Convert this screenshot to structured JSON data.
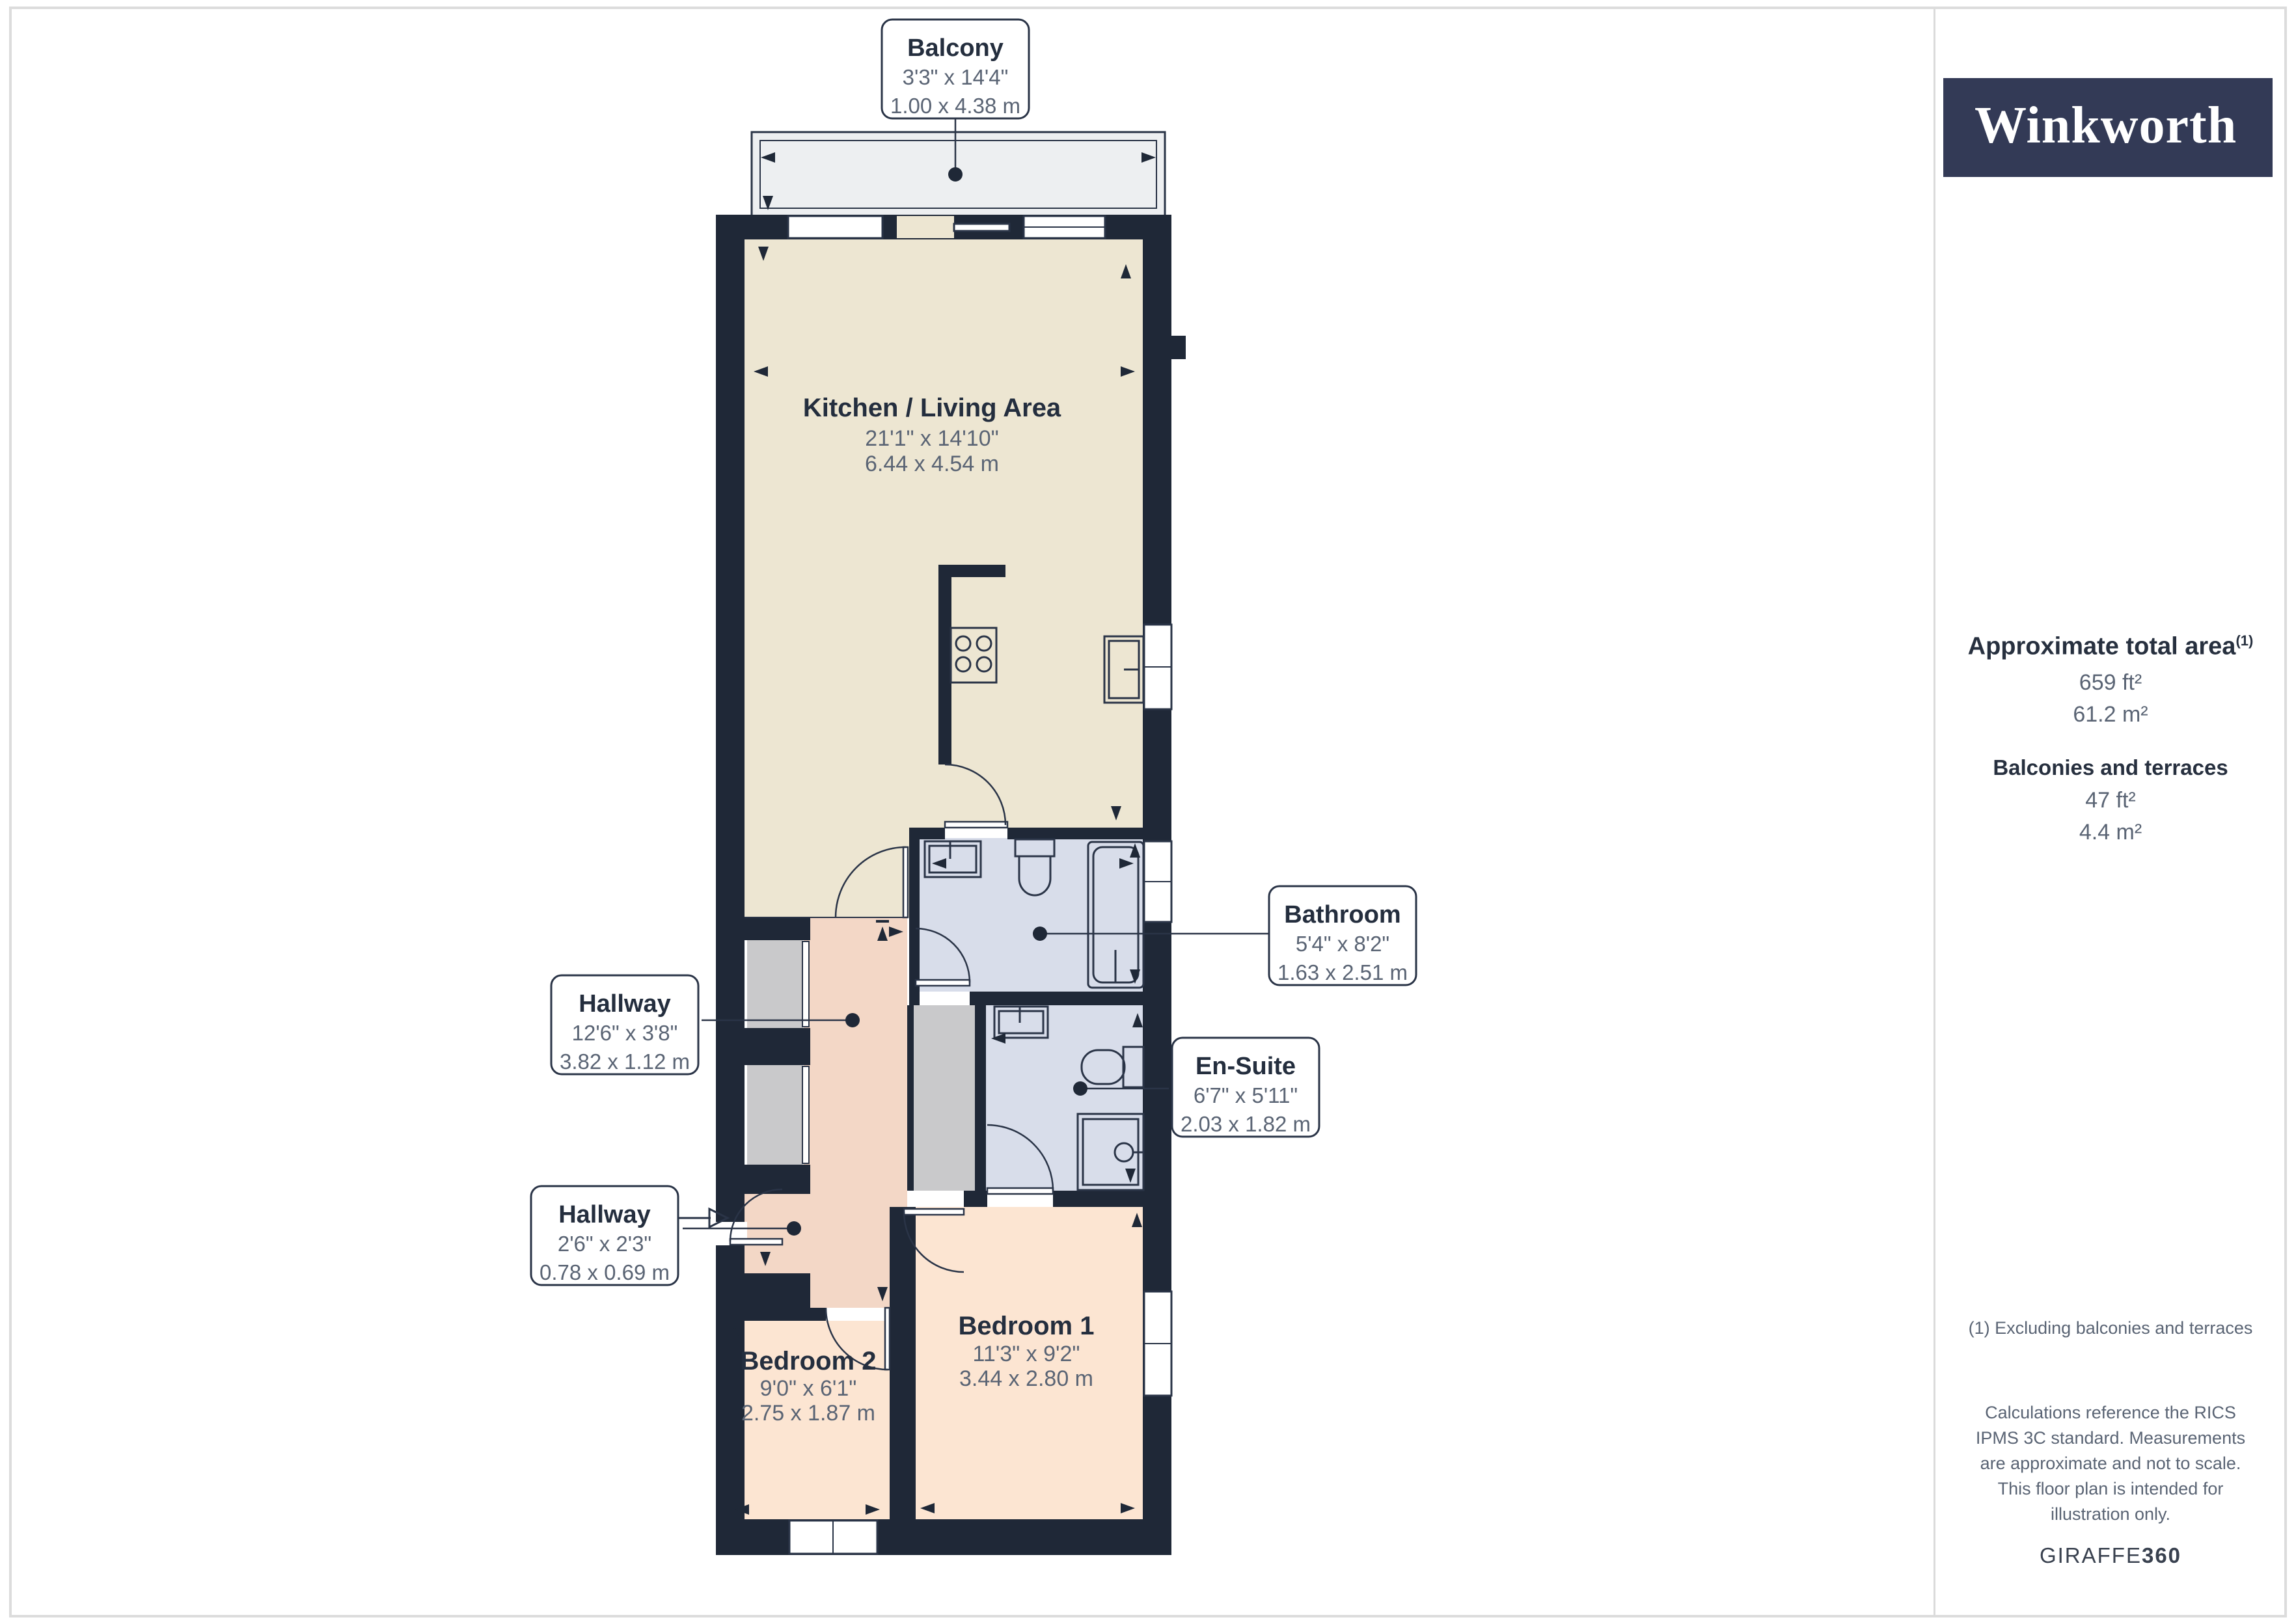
{
  "brand": {
    "logo_text": "Winkworth"
  },
  "sidebar": {
    "total_area": {
      "label": "Approximate total area",
      "superscript": "(1)",
      "imperial": "659 ft²",
      "metric": "61.2 m²"
    },
    "balconies": {
      "label": "Balconies and terraces",
      "imperial": "47 ft²",
      "metric": "4.4 m²"
    },
    "footnote": "(1) Excluding balconies and terraces",
    "disclaimer": "Calculations reference the RICS IPMS 3C standard. Measurements are approximate and not to scale. This floor plan is intended for illustration only.",
    "credit_brand": "GIRAFFE",
    "credit_suffix": "360"
  },
  "rooms": {
    "balcony": {
      "name": "Balcony",
      "imperial": "3'3\" x 14'4\"",
      "metric": "1.00 x 4.38 m"
    },
    "kitchen": {
      "name": "Kitchen / Living Area",
      "imperial": "21'1\" x 14'10\"",
      "metric": "6.44 x 4.54 m"
    },
    "bathroom": {
      "name": "Bathroom",
      "imperial": "5'4\" x 8'2\"",
      "metric": "1.63 x 2.51 m"
    },
    "hallway1": {
      "name": "Hallway",
      "imperial": "12'6\" x 3'8\"",
      "metric": "3.82 x 1.12 m"
    },
    "ensuite": {
      "name": "En-Suite",
      "imperial": "6'7\" x 5'11\"",
      "metric": "2.03 x 1.82 m"
    },
    "hallway2": {
      "name": "Hallway",
      "imperial": "2'6\" x 2'3\"",
      "metric": "0.78 x 0.69 m"
    },
    "bedroom1": {
      "name": "Bedroom 1",
      "imperial": "11'3\" x 9'2\"",
      "metric": "3.44 x 2.80 m"
    },
    "bedroom2": {
      "name": "Bedroom 2",
      "imperial": "9'0\" x 6'1\"",
      "metric": "2.75 x 1.87 m"
    }
  },
  "colors": {
    "wall": "#1f2837",
    "kitchen_fill": "#ede6d2",
    "bedroom_fill": "#fce5d2",
    "hallway_fill": "#f3d7c6",
    "bath_fill": "#d8ddea",
    "closet_fill": "#c9c9cb",
    "balcony_fill": "#edeff1",
    "brand_navy": "#333a56",
    "line": "#2a3447"
  }
}
